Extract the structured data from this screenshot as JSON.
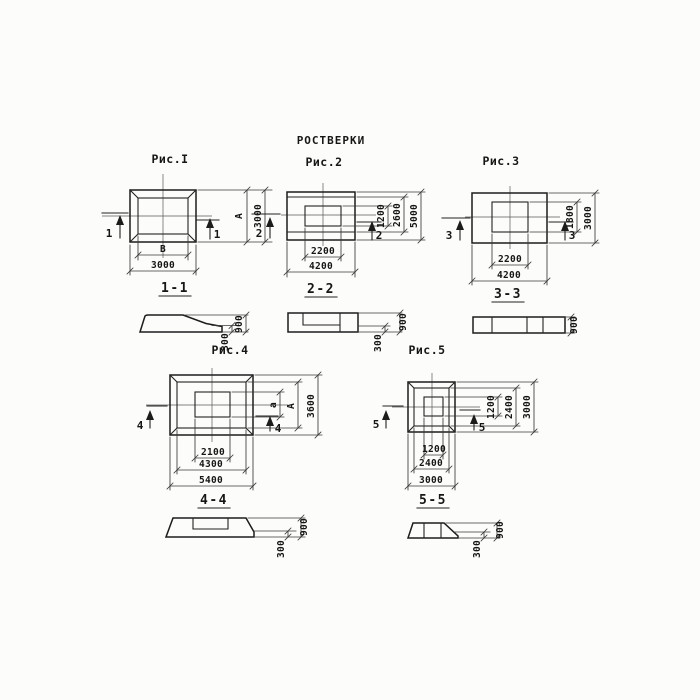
{
  "page": {
    "title": "РОСТВЕРКИ"
  },
  "fig1": {
    "caption": "Рис.I",
    "marker": "1",
    "section_title": "1-1",
    "dim_right_inner": "А",
    "dim_right_outer": "3000",
    "dim_bottom_inner": "В",
    "dim_bottom_outer": "3000",
    "sec_height": "900",
    "sec_step": "300"
  },
  "fig2": {
    "caption": "Рис.2",
    "marker": "2",
    "section_title": "2-2",
    "dim_right_inner": "1200",
    "dim_right_mid": "2600",
    "dim_right_outer": "5000",
    "dim_bottom_inner": "2200",
    "dim_bottom_outer": "4200",
    "sec_height": "900",
    "sec_step": "300"
  },
  "fig3": {
    "caption": "Рис.3",
    "marker": "3",
    "section_title": "3-3",
    "dim_right_inner": "1800",
    "dim_right_outer": "3000",
    "dim_bottom_inner": "2200",
    "dim_bottom_outer": "4200",
    "sec_height": "900"
  },
  "fig4": {
    "caption": "Рис.4",
    "marker": "4",
    "section_title": "4-4",
    "dim_right_inner": "а",
    "dim_right_mid": "А",
    "dim_right_outer": "3600",
    "dim_bottom_inner": "2100",
    "dim_bottom_mid": "4300",
    "dim_bottom_outer": "5400",
    "sec_height": "900",
    "sec_step": "300"
  },
  "fig5": {
    "caption": "Рис.5",
    "marker": "5",
    "section_title": "5-5",
    "dim_right_inner": "1200",
    "dim_right_mid": "2400",
    "dim_right_outer": "3000",
    "dim_bottom_inner": "1200",
    "dim_bottom_mid": "2400",
    "dim_bottom_outer": "3000",
    "sec_height": "900",
    "sec_step": "300"
  }
}
